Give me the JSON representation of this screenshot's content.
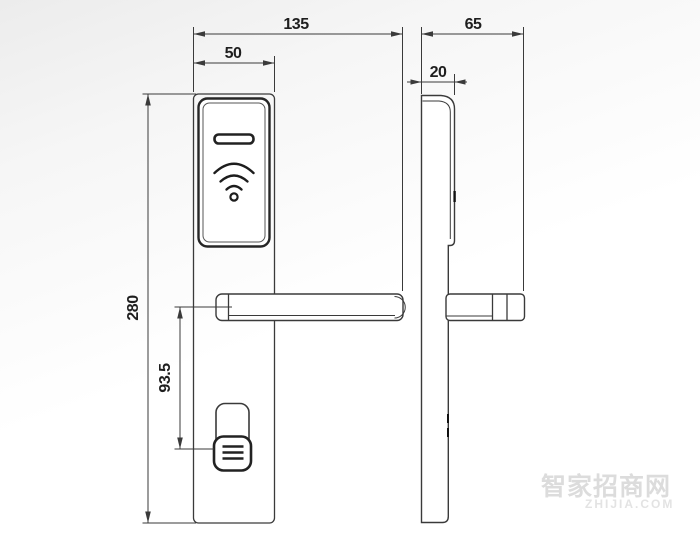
{
  "drawing": {
    "type": "technical-drawing",
    "subject": "rfid-door-lock-front-and-side-view",
    "line_color": "#3a3a3a",
    "dims": {
      "front_overall_width": "135",
      "front_plate_width": "50",
      "side_overall_depth": "65",
      "side_reader_thickness": "20",
      "plate_height": "280",
      "handle_to_knob_offset": "93.5"
    },
    "icons": {
      "rfid_symbol": "wifi-arcs-icon",
      "card_slot": "card-slot-shape",
      "knob_ridges": "grip-lines"
    }
  },
  "watermark": {
    "cn": "智家招商网",
    "en": "ZHIJIA.COM",
    "color": "#dcdcdc"
  }
}
